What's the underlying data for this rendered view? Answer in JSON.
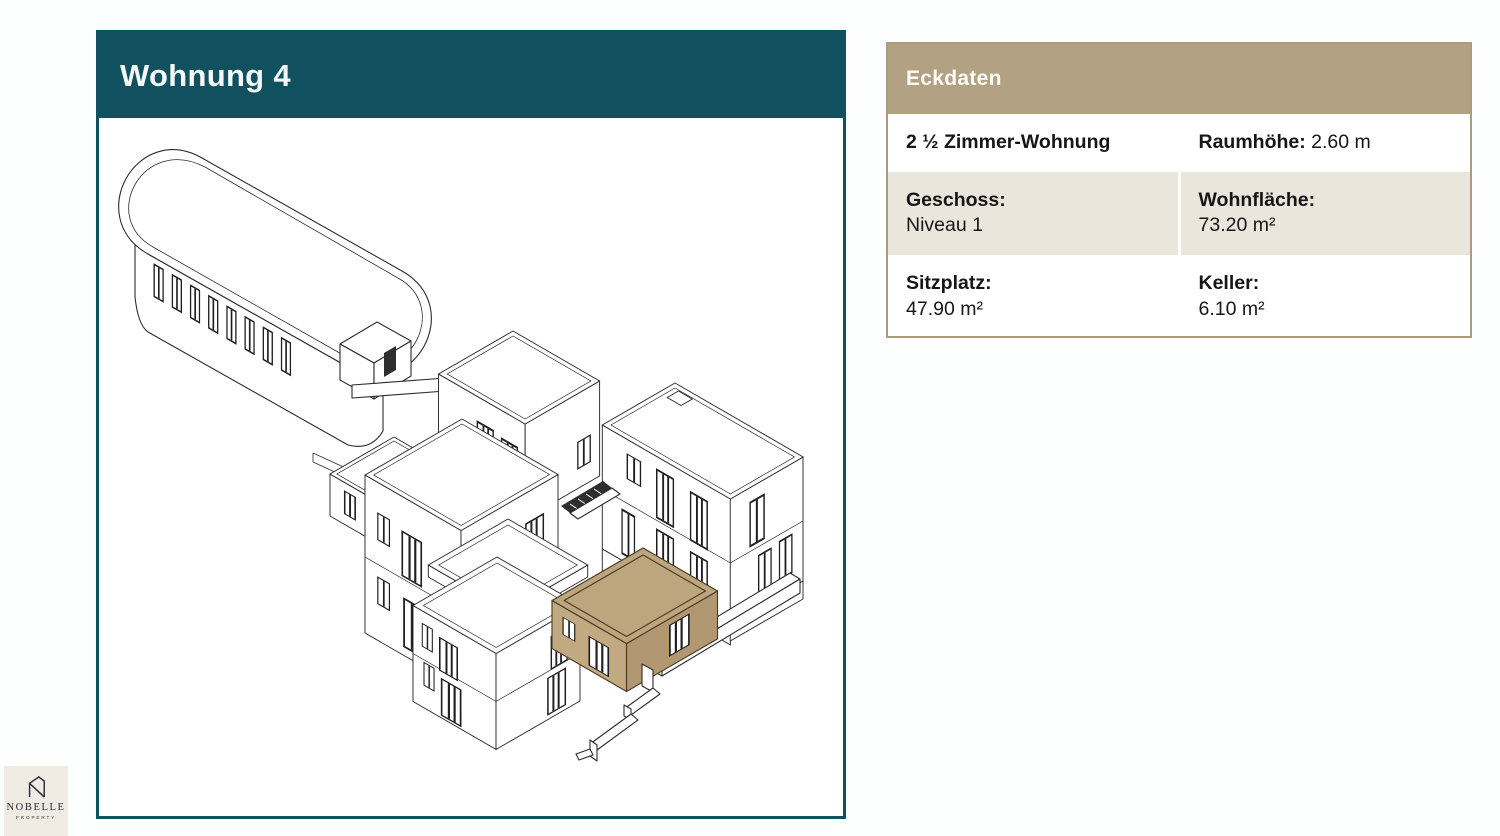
{
  "page": {
    "title": "Wohnung 4"
  },
  "panel": {
    "header": "Eckdaten",
    "rows": [
      {
        "cells": [
          {
            "label": "2 ½ Zimmer-Wohnung",
            "value": ""
          },
          {
            "label": "Raumhöhe:",
            "value": "2.60 m"
          }
        ]
      },
      {
        "cells": [
          {
            "label": "Geschoss:",
            "value": "Niveau 1"
          },
          {
            "label": "Wohnfläche:",
            "value": "73.20 m²"
          }
        ]
      },
      {
        "cells": [
          {
            "label": "Sitzplatz:",
            "value": "47.90 m²"
          },
          {
            "label": "Keller:",
            "value": "6.10 m²"
          }
        ]
      }
    ]
  },
  "drawing": {
    "type": "isometric-site-plan",
    "highlighted_unit": "Wohnung 4",
    "highlight_color": "#bda67e"
  },
  "logo": {
    "name": "NOBELLE",
    "tagline": "PROPERTY"
  },
  "colors": {
    "teal": "#11505e",
    "tan_header": "#b2a183",
    "beige_row": "#eae6dc",
    "logo_bg": "#f1ece3",
    "line": "#2b2b2b"
  }
}
